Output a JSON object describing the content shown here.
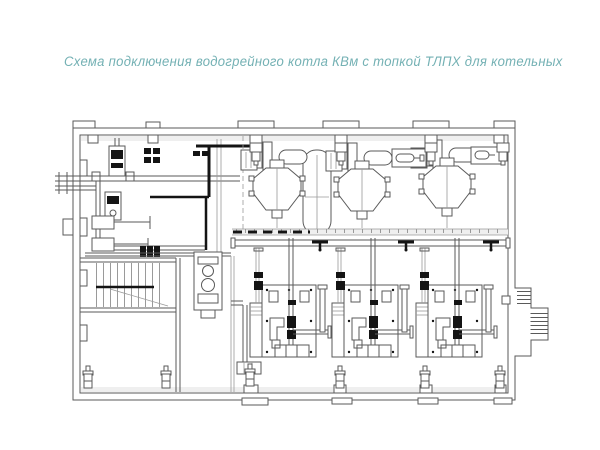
{
  "title": {
    "text": "Схема подключения водогрейного котла КВм с топкой ТЛПХ  для котельных"
  },
  "colors": {
    "title": "#74b1b4",
    "line": "#5a5a5a",
    "line_light": "#9a9a9a",
    "dark": "#141414",
    "fill_strip": "#efefef",
    "background": "#ffffff"
  }
}
